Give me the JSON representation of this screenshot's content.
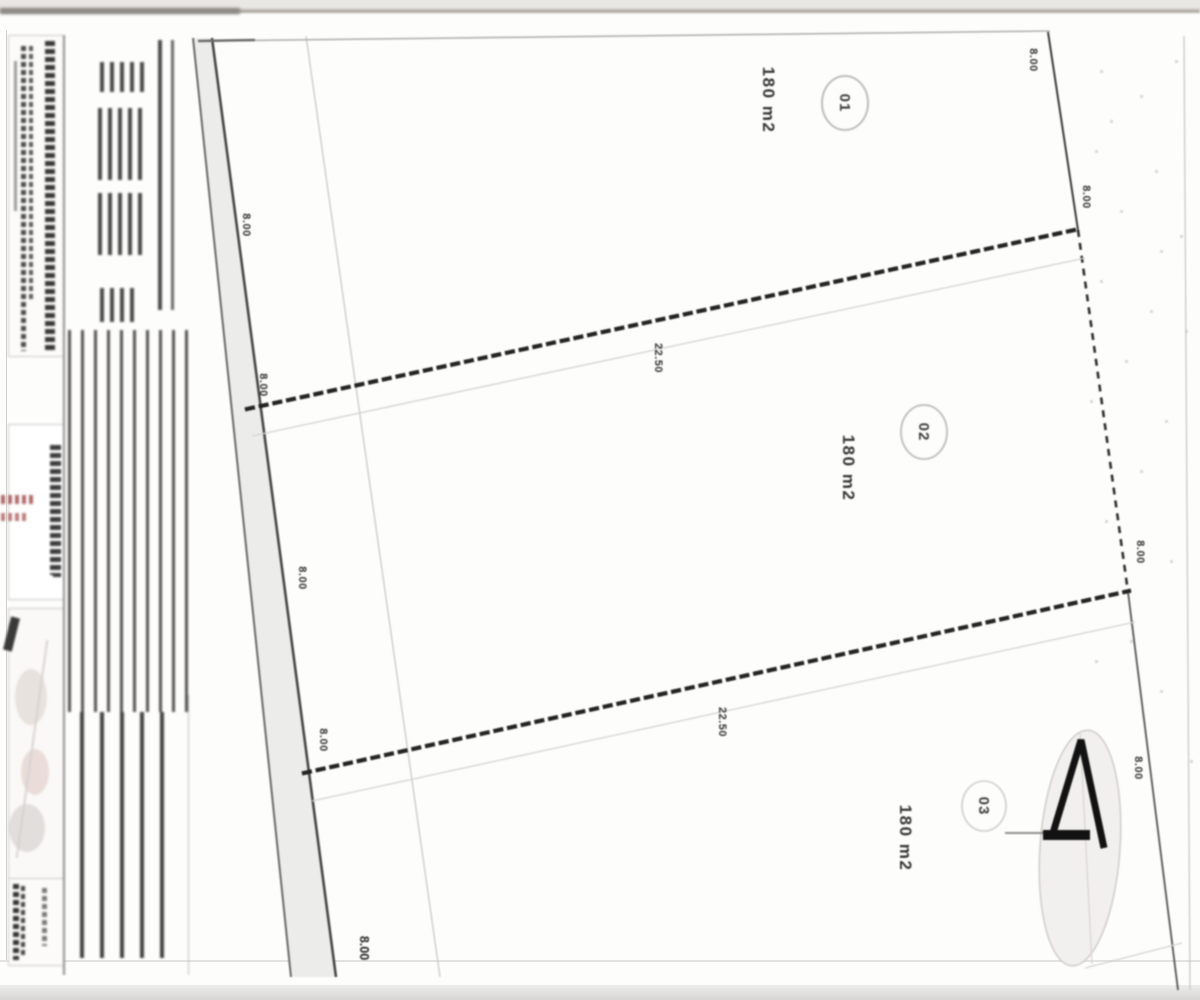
{
  "document": {
    "kind": "scanned subdivision / lot survey plan",
    "orientation_note": "all plan text rotated 90°"
  },
  "plan": {
    "lots": [
      {
        "number": "01",
        "area": "180 m2"
      },
      {
        "number": "02",
        "area": "180 m2"
      },
      {
        "number": "03",
        "area": "180 m2"
      }
    ],
    "dimensions": [
      {
        "value": "8.00"
      },
      {
        "value": "22.50"
      },
      {
        "value": "8.00"
      },
      {
        "value": "8.00"
      },
      {
        "value": "8.00"
      },
      {
        "value": "8.00"
      },
      {
        "value": "8.00"
      },
      {
        "value": "22.50"
      },
      {
        "value": "8.00"
      },
      {
        "value": "8.00"
      },
      {
        "value": "8.00"
      }
    ]
  },
  "icons": {
    "north_arrow": "north-arrow-icon"
  },
  "colors": {
    "paper": "#fdfdfc",
    "boundary_line": "#2b2b2b",
    "faint_line": "#c9c9c9",
    "road_fill": "#ececea",
    "stamp_red": "#b06a6a",
    "compass_fill": "#f2f0ee"
  }
}
